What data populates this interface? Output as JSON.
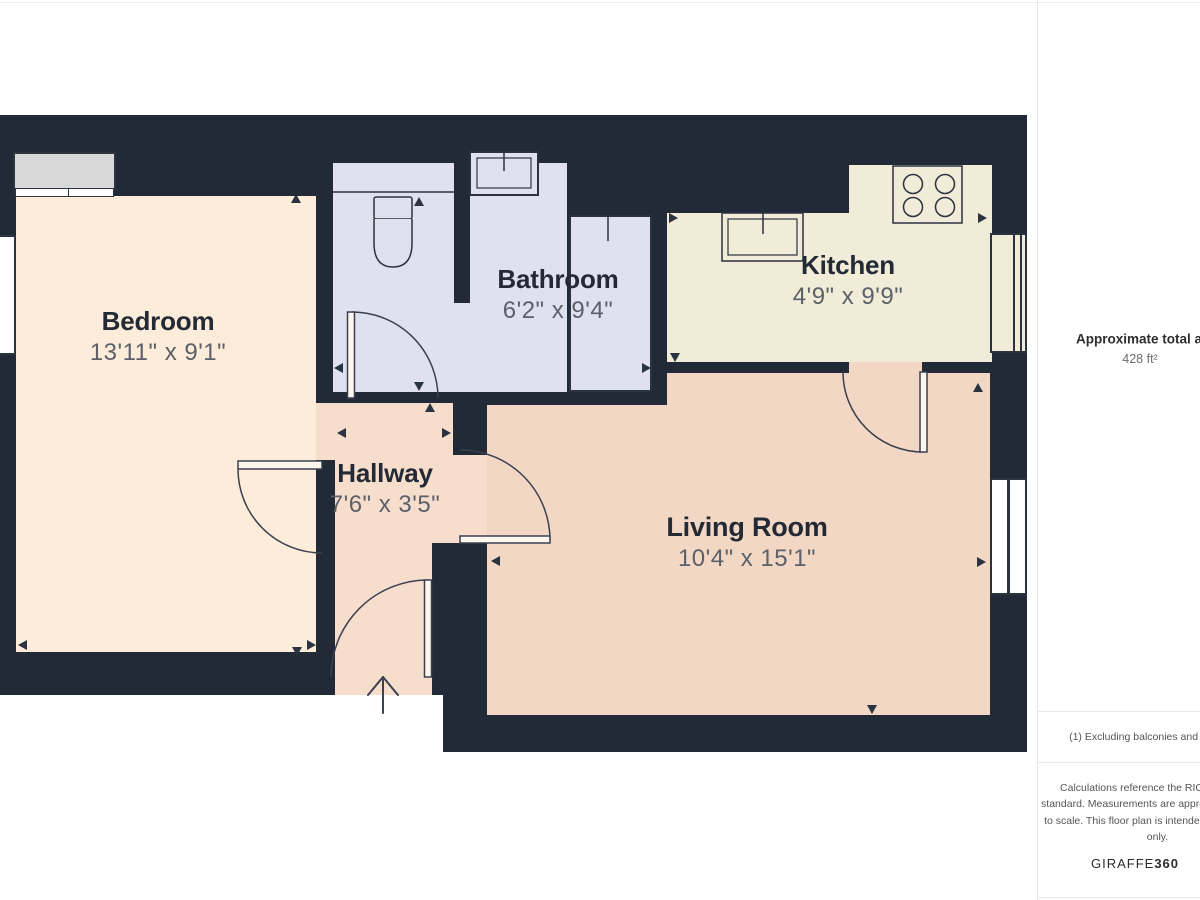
{
  "plan": {
    "background": "#222a37",
    "wall_line_color": "#2b3240",
    "rooms": [
      {
        "name": "Bedroom",
        "dims": "13'11\" x 9'1\"",
        "color": "#fcecd9"
      },
      {
        "name": "Bathroom",
        "dims": "6'2\" x 9'4\"",
        "color": "#dfe2ee"
      },
      {
        "name": "Kitchen",
        "dims": "4'9\" x 9'9\"",
        "color": "#f0ecd8"
      },
      {
        "name": "Hallway",
        "dims": "7'6\" x 3'5\"",
        "color": "#f7ddcc"
      },
      {
        "name": "Living Room",
        "dims": "10'4\" x 15'1\"",
        "color": "#f2d7c5"
      }
    ],
    "fixtures": [
      "wardrobe",
      "toilet",
      "bathroom-sink",
      "shower-cubicle",
      "kitchen-sink",
      "hob",
      "windows",
      "doors",
      "entrance-arrow",
      "measurement-arrows"
    ]
  },
  "sidebar": {
    "area_label": "Approximate total area",
    "area_sup": "(1)",
    "area_value": "428 ft²",
    "footnote": "(1) Excluding balconies and terraces",
    "disclaimer": "Calculations reference the RICS IPMS 3C standard. Measurements are approximate and not to scale. This floor plan is intended for illustration only.",
    "brand_name": "GIRAFFE",
    "brand_suffix": "360"
  }
}
